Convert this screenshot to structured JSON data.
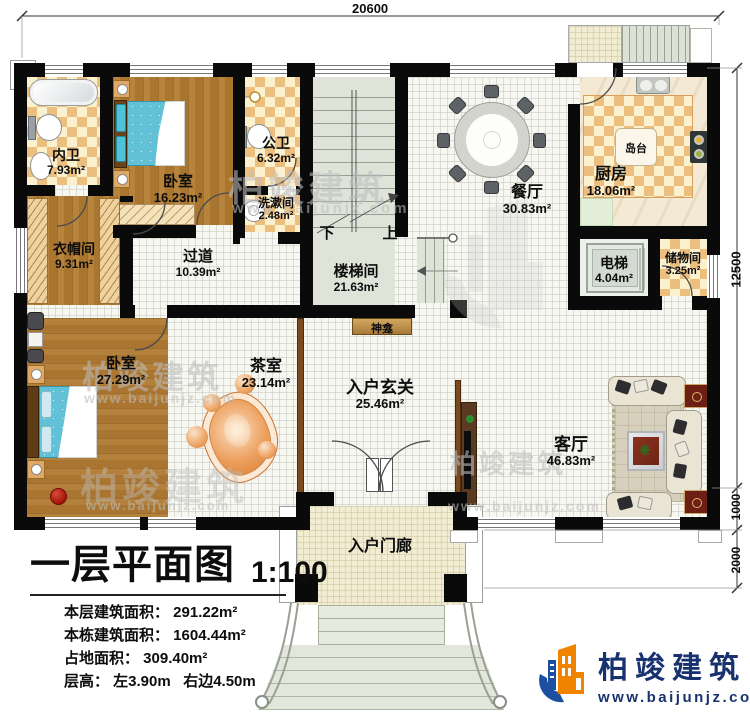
{
  "dimensions": {
    "top": "20600",
    "right_total": "12500",
    "right_seg1": "1000",
    "right_seg2": "2000"
  },
  "rooms": {
    "neiwei": {
      "name": "内卫",
      "area": "7.93m²"
    },
    "bedroom_top": {
      "name": "卧室",
      "area": "16.23m²"
    },
    "gongwei": {
      "name": "公卫",
      "area": "6.32m²"
    },
    "xishujian": {
      "name": "洗漱间",
      "area": "2.48m²"
    },
    "cloakroom": {
      "name": "衣帽间",
      "area": "9.31m²"
    },
    "corridor": {
      "name": "过道",
      "area": "10.39m²"
    },
    "stairwell": {
      "name": "楼梯间",
      "area": "21.63m²"
    },
    "dining": {
      "name": "餐厅",
      "area": "30.83m²"
    },
    "kitchen": {
      "name": "厨房",
      "area": "18.06m²"
    },
    "elevator": {
      "name": "电梯",
      "area": "4.04m²"
    },
    "storage": {
      "name": "储物间",
      "area": "3.25m²"
    },
    "bedroom_main": {
      "name": "卧室",
      "area": "27.29m²"
    },
    "tearoom": {
      "name": "茶室",
      "area": "23.14m²"
    },
    "foyer": {
      "name": "入户玄关",
      "area": "25.46m²"
    },
    "living": {
      "name": "客厅",
      "area": "46.83m²"
    }
  },
  "annotations": {
    "island": "岛台",
    "shrine": "神龛",
    "porch": "入户门廊",
    "stair_up": "上",
    "stair_down": "下"
  },
  "title_block": {
    "title": "一层平面图",
    "scale": "1:100",
    "lines": [
      "本层建筑面积： 291.22m²",
      "本栋建筑面积： 1604.44m²",
      "占地面积： 309.40m²",
      "层高： 左3.90m   右边4.50m"
    ]
  },
  "branding": {
    "company": "柏竣建筑",
    "website": "www.baijunjz.com"
  },
  "watermark": {
    "company": "柏竣建筑",
    "website": "www.baijunjz.com"
  },
  "colors": {
    "wall": "#0a0a0a",
    "checker_orange": "#edbf7f",
    "wood": "#a9752f",
    "stair_green": "#dfe4d9",
    "brand_blue": "#17326e",
    "brand_orange": "#f08300"
  }
}
